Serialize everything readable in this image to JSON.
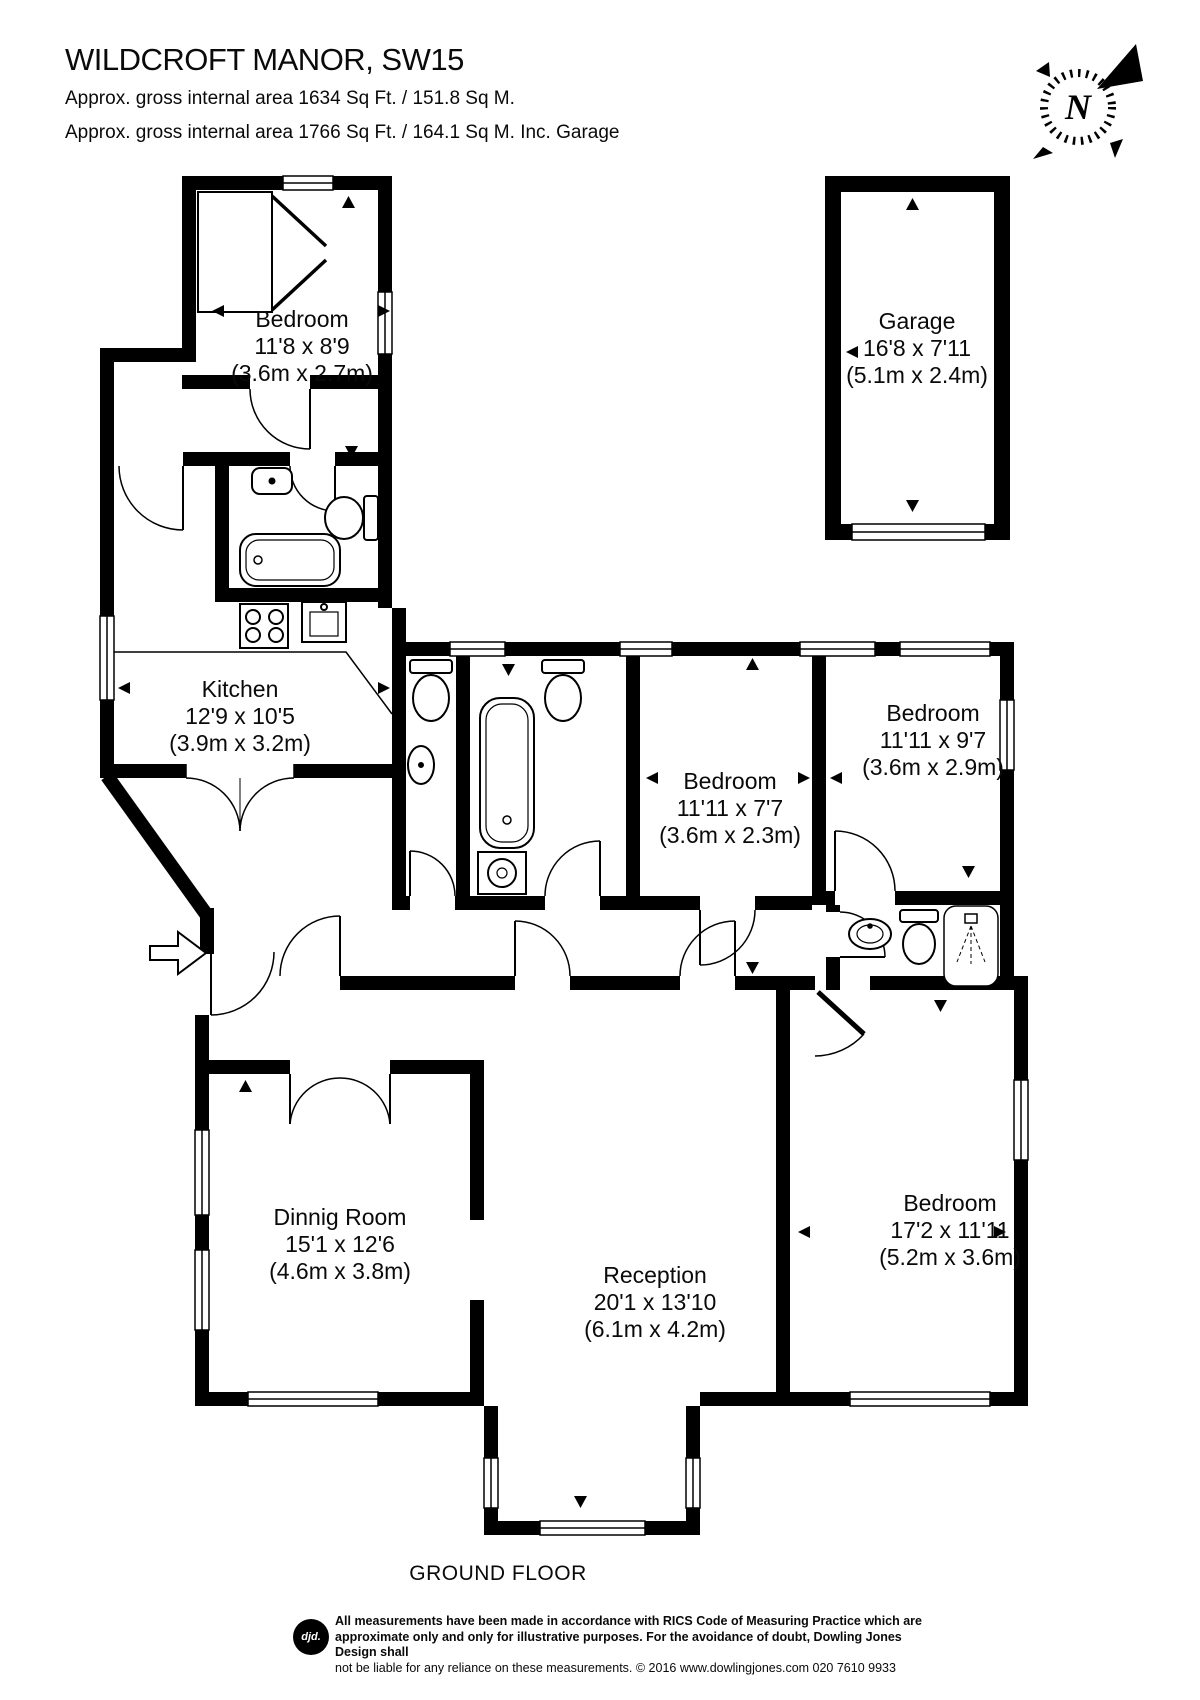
{
  "header": {
    "title": "WILDCROFT MANOR, SW15",
    "area_line_1": "Approx. gross internal area 1634 Sq Ft. / 151.8 Sq M.",
    "area_line_2": "Approx. gross internal area 1766 Sq Ft. / 164.1 Sq M. Inc. Garage"
  },
  "compass": {
    "label": "N"
  },
  "rooms": [
    {
      "id": "bedroom-1",
      "name": "Bedroom",
      "size_ft": "11'8 x 8'9",
      "size_m": "(3.6m x 2.7m)"
    },
    {
      "id": "garage",
      "name": "Garage",
      "size_ft": "16'8 x 7'11",
      "size_m": "(5.1m x 2.4m)"
    },
    {
      "id": "kitchen",
      "name": "Kitchen",
      "size_ft": "12'9 x 10'5",
      "size_m": "(3.9m x 3.2m)"
    },
    {
      "id": "bedroom-2",
      "name": "Bedroom",
      "size_ft": "11'11 x 7'7",
      "size_m": "(3.6m x 2.3m)"
    },
    {
      "id": "bedroom-3",
      "name": "Bedroom",
      "size_ft": "11'11 x 9'7",
      "size_m": "(3.6m x 2.9m)"
    },
    {
      "id": "dining-room",
      "name": "Dinnig Room",
      "size_ft": "15'1 x 12'6",
      "size_m": "(4.6m x 3.8m)"
    },
    {
      "id": "reception",
      "name": "Reception",
      "size_ft": "20'1 x 13'10",
      "size_m": "(6.1m x 4.2m)"
    },
    {
      "id": "bedroom-4",
      "name": "Bedroom",
      "size_ft": "17'2 x 11'11",
      "size_m": "(5.2m x 3.6m)"
    }
  ],
  "floor_label": "GROUND FLOOR",
  "footer": {
    "logo": "djd.",
    "line_1": "All measurements have been made in accordance with RICS Code of Measuring Practice which are",
    "line_2": "approximate only and only for illustrative purposes. For the avoidance of doubt, Dowling Jones Design shall",
    "line_3": "not be liable for any reliance on these measurements. © 2016 www.dowlingjones.com 020 7610 9933"
  },
  "colors": {
    "wall": "#000000",
    "background": "#ffffff",
    "text": "#0a0a0a"
  }
}
